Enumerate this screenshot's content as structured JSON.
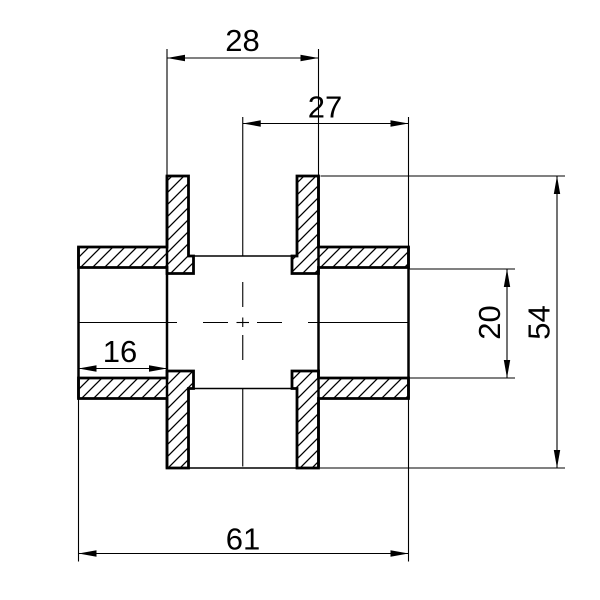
{
  "drawing": {
    "background_color": "#ffffff",
    "line_color": "#000000",
    "type_hint": "cross-fitting-section-drawing",
    "dimensions": {
      "vertical_pipe_outer_width": "28",
      "center_to_right_edge": "27",
      "left_socket_depth": "16",
      "bore_inner_height": "20",
      "overall_height": "54",
      "overall_width": "61"
    }
  }
}
